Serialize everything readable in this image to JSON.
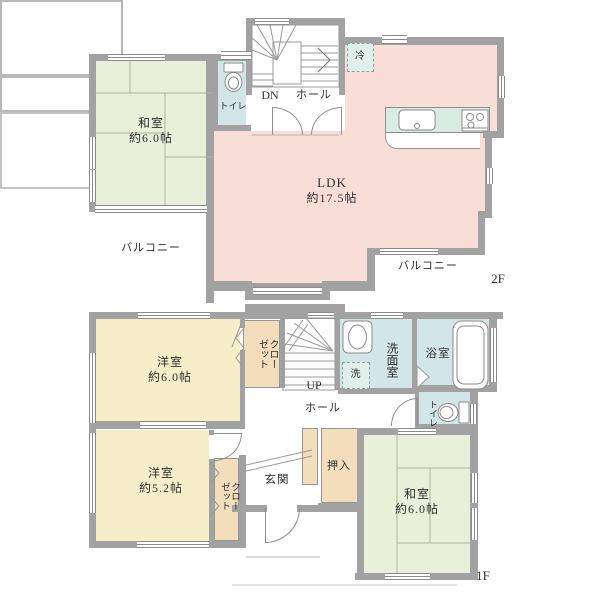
{
  "plan_title": "住宅間取り図",
  "colors": {
    "wall": "#a2a2a2",
    "tatami_room": "#e9f0da",
    "western_room": "#f6eec9",
    "wet_area": "#d3e6e7",
    "ldk": "#f9ded8",
    "closet": "#f3ddbb",
    "kitchen_counter": "#d9ece2",
    "dashed_fixture": "#e0efe9",
    "text": "#2f2f2f"
  },
  "floor2": {
    "label": "2F",
    "rooms": {
      "washitsu": {
        "name": "和室",
        "size": "約6.0帖"
      },
      "toilet": {
        "name": "トイレ"
      },
      "stairs": {
        "name": "DN"
      },
      "hall": {
        "name": "ホール"
      },
      "fridge": {
        "name": "冷"
      },
      "ldk": {
        "name": "LDK",
        "size": "約17.5帖"
      },
      "balcony_left": {
        "name": "バルコニー"
      },
      "balcony_right": {
        "name": "バルコニー"
      }
    }
  },
  "floor1": {
    "label": "1F",
    "rooms": {
      "western6": {
        "name": "洋室",
        "size": "約6.0帖"
      },
      "closet_north": {
        "name": "クローゼット"
      },
      "stairs": {
        "name": "UP"
      },
      "hall": {
        "name": "ホール"
      },
      "washroom": {
        "name": "洗面室"
      },
      "laundry": {
        "name": "洗"
      },
      "bath": {
        "name": "浴室"
      },
      "toilet": {
        "name": "トイレ"
      },
      "entrance": {
        "name": "玄関"
      },
      "oshiire": {
        "name": "押入"
      },
      "western52": {
        "name": "洋室",
        "size": "約5.2帖"
      },
      "closet_south": {
        "name": "クローゼット"
      },
      "washitsu": {
        "name": "和室",
        "size": "約6.0帖"
      }
    }
  }
}
